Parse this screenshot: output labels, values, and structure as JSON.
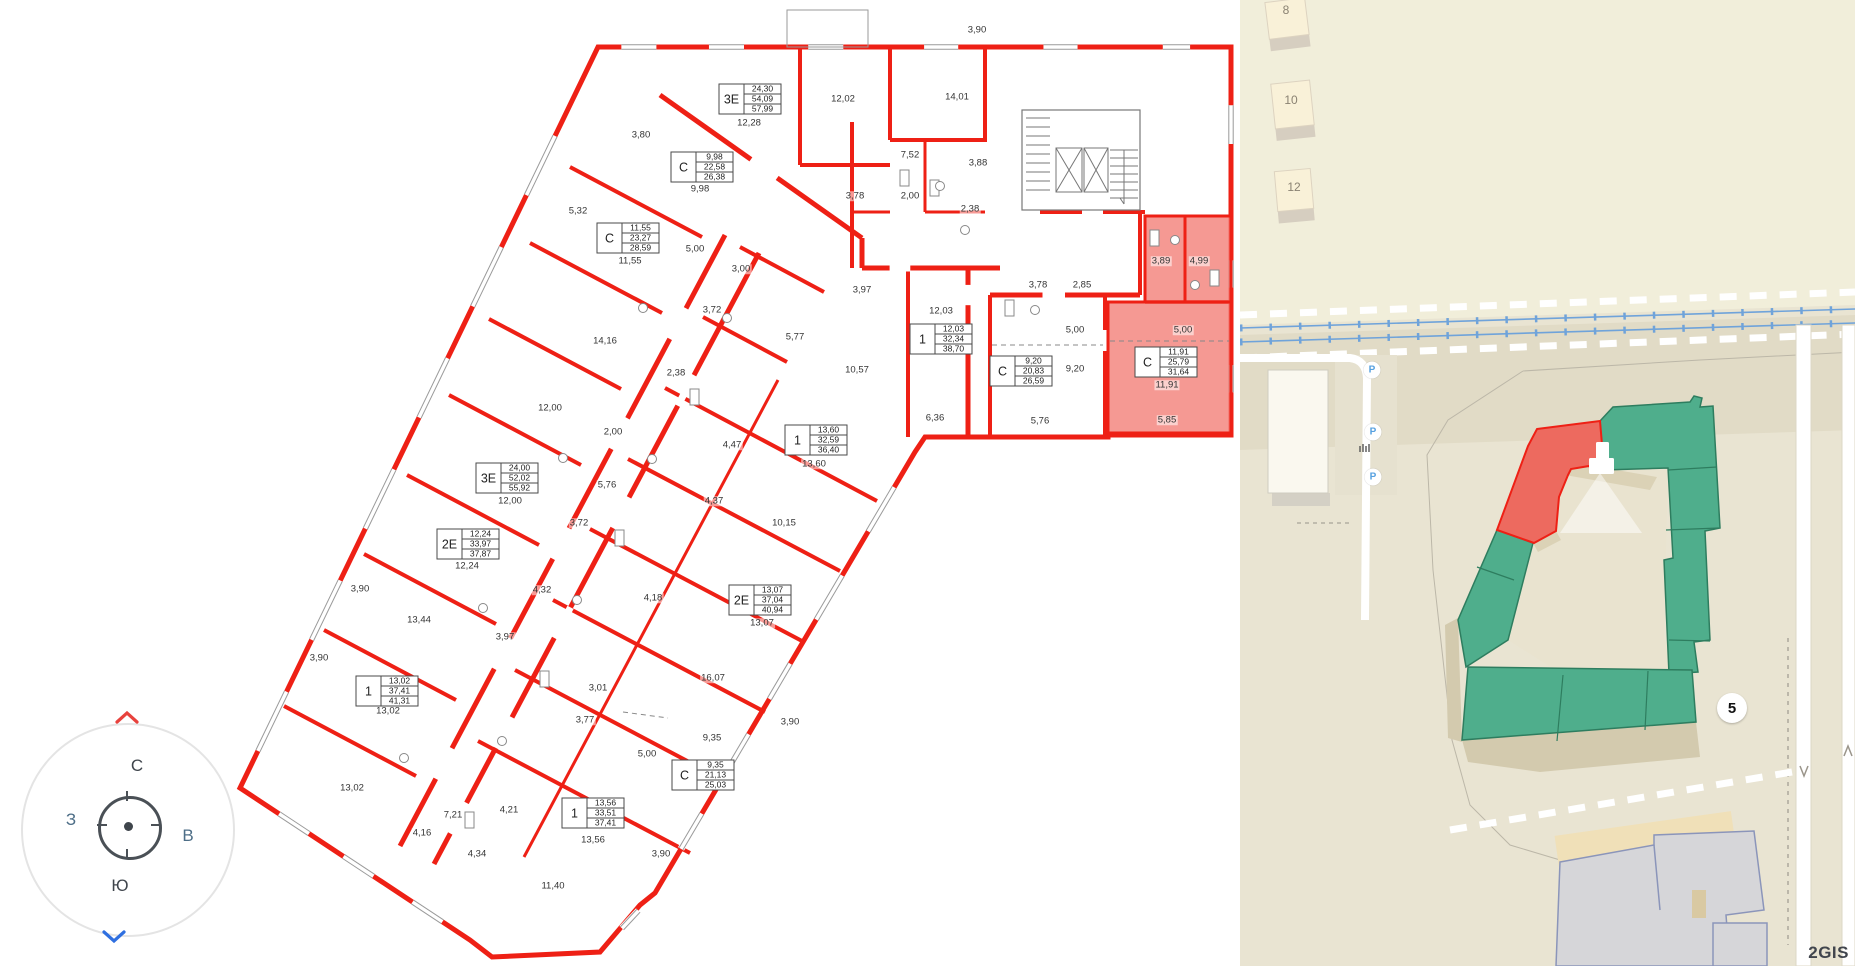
{
  "colors": {
    "wall_red": "#ee2015",
    "highlight_fill": "#f28078",
    "gray_line": "#9a9a9a",
    "map_bg": "#e9e4d2",
    "map_bg_upper": "#f1eeda",
    "map_bg_band": "#e1dbc6",
    "building_cream": "#f9f1d8",
    "building_shadow": "#d6cec0",
    "green_fill": "#4fae8c",
    "green_border": "#2e7d5f",
    "red_fill": "#ed6a5f",
    "gray_building": "#d6d6d9",
    "gray_building_border": "#8b95ba",
    "railway_blue": "#6fa3da",
    "parking_blue": "#57a1e0"
  },
  "floorplan": {
    "apartments": [
      {
        "type": "3Е",
        "values": [
          "24,30",
          "54,09",
          "57,99"
        ],
        "x": 750,
        "y": 99,
        "highlighted": false
      },
      {
        "type": "С",
        "values": [
          "9,98",
          "22,58",
          "26,38"
        ],
        "x": 702,
        "y": 167,
        "highlighted": false
      },
      {
        "type": "С",
        "values": [
          "11,55",
          "23,27",
          "28,59"
        ],
        "x": 628,
        "y": 238,
        "highlighted": false
      },
      {
        "type": "1",
        "values": [
          "12,03",
          "32,34",
          "38,70"
        ],
        "x": 941,
        "y": 339,
        "highlighted": false
      },
      {
        "type": "С",
        "values": [
          "9,20",
          "20,83",
          "26,59"
        ],
        "x": 1021,
        "y": 371,
        "highlighted": false
      },
      {
        "type": "С",
        "values": [
          "11,91",
          "25,79",
          "31,64"
        ],
        "x": 1166,
        "y": 362,
        "highlighted": true
      },
      {
        "type": "1",
        "values": [
          "13,60",
          "32,59",
          "36,40"
        ],
        "x": 816,
        "y": 440,
        "highlighted": false
      },
      {
        "type": "3Е",
        "values": [
          "24,00",
          "52,02",
          "55,92"
        ],
        "x": 507,
        "y": 478,
        "highlighted": false
      },
      {
        "type": "2Е",
        "values": [
          "12,24",
          "33,97",
          "37,87"
        ],
        "x": 468,
        "y": 544,
        "highlighted": false
      },
      {
        "type": "2Е",
        "values": [
          "13,07",
          "37,04",
          "40,94"
        ],
        "x": 760,
        "y": 600,
        "highlighted": false
      },
      {
        "type": "1",
        "values": [
          "13,02",
          "37,41",
          "41,31"
        ],
        "x": 387,
        "y": 691,
        "highlighted": false
      },
      {
        "type": "С",
        "values": [
          "9,35",
          "21,13",
          "25,03"
        ],
        "x": 703,
        "y": 775,
        "highlighted": false
      },
      {
        "type": "1",
        "values": [
          "13,56",
          "33,51",
          "37,41"
        ],
        "x": 593,
        "y": 813,
        "highlighted": false
      }
    ],
    "dimensions": [
      {
        "t": "3,90",
        "x": 977,
        "y": 30
      },
      {
        "t": "12,28",
        "x": 749,
        "y": 123
      },
      {
        "t": "12,02",
        "x": 843,
        "y": 99
      },
      {
        "t": "14,01",
        "x": 957,
        "y": 97
      },
      {
        "t": "3,80",
        "x": 641,
        "y": 135
      },
      {
        "t": "7,52",
        "x": 910,
        "y": 155
      },
      {
        "t": "3,88",
        "x": 978,
        "y": 163
      },
      {
        "t": "9,98",
        "x": 700,
        "y": 189
      },
      {
        "t": "3,78",
        "x": 855,
        "y": 196
      },
      {
        "t": "2,00",
        "x": 910,
        "y": 196
      },
      {
        "t": "2,38",
        "x": 970,
        "y": 209
      },
      {
        "t": "5,32",
        "x": 578,
        "y": 211
      },
      {
        "t": "5,00",
        "x": 695,
        "y": 249
      },
      {
        "t": "11,55",
        "x": 630,
        "y": 261
      },
      {
        "t": "3,00",
        "x": 741,
        "y": 269
      },
      {
        "t": "3,89",
        "x": 1161,
        "y": 261
      },
      {
        "t": "4,99",
        "x": 1199,
        "y": 261
      },
      {
        "t": "3,78",
        "x": 1038,
        "y": 285
      },
      {
        "t": "2,85",
        "x": 1082,
        "y": 285
      },
      {
        "t": "3,97",
        "x": 862,
        "y": 290
      },
      {
        "t": "3,72",
        "x": 712,
        "y": 310
      },
      {
        "t": "12,03",
        "x": 941,
        "y": 311
      },
      {
        "t": "5,00",
        "x": 1075,
        "y": 330
      },
      {
        "t": "5,00",
        "x": 1183,
        "y": 330
      },
      {
        "t": "5,77",
        "x": 795,
        "y": 337
      },
      {
        "t": "14,16",
        "x": 605,
        "y": 341
      },
      {
        "t": "9,20",
        "x": 1075,
        "y": 369
      },
      {
        "t": "10,57",
        "x": 857,
        "y": 370
      },
      {
        "t": "2,38",
        "x": 676,
        "y": 373
      },
      {
        "t": "11,91",
        "x": 1167,
        "y": 385
      },
      {
        "t": "12,00",
        "x": 550,
        "y": 408
      },
      {
        "t": "6,36",
        "x": 935,
        "y": 418
      },
      {
        "t": "5,76",
        "x": 1040,
        "y": 421
      },
      {
        "t": "5,85",
        "x": 1167,
        "y": 420
      },
      {
        "t": "2,00",
        "x": 613,
        "y": 432
      },
      {
        "t": "4,47",
        "x": 732,
        "y": 445
      },
      {
        "t": "13,60",
        "x": 814,
        "y": 464
      },
      {
        "t": "5,76",
        "x": 607,
        "y": 485
      },
      {
        "t": "12,00",
        "x": 510,
        "y": 501
      },
      {
        "t": "4,37",
        "x": 714,
        "y": 501
      },
      {
        "t": "3,72",
        "x": 579,
        "y": 523
      },
      {
        "t": "10,15",
        "x": 784,
        "y": 523
      },
      {
        "t": "12,24",
        "x": 467,
        "y": 566
      },
      {
        "t": "3,90",
        "x": 360,
        "y": 589
      },
      {
        "t": "4,32",
        "x": 542,
        "y": 590
      },
      {
        "t": "4,18",
        "x": 653,
        "y": 598
      },
      {
        "t": "13,44",
        "x": 419,
        "y": 620
      },
      {
        "t": "13,07",
        "x": 762,
        "y": 623
      },
      {
        "t": "3,97",
        "x": 505,
        "y": 637
      },
      {
        "t": "3,90",
        "x": 319,
        "y": 658
      },
      {
        "t": "16,07",
        "x": 713,
        "y": 678
      },
      {
        "t": "3,01",
        "x": 598,
        "y": 688
      },
      {
        "t": "13,02",
        "x": 388,
        "y": 711
      },
      {
        "t": "3,77",
        "x": 585,
        "y": 720
      },
      {
        "t": "3,90",
        "x": 790,
        "y": 722
      },
      {
        "t": "9,35",
        "x": 712,
        "y": 738
      },
      {
        "t": "5,00",
        "x": 647,
        "y": 754
      },
      {
        "t": "3,90",
        "x": 717,
        "y": 785
      },
      {
        "t": "13,02",
        "x": 352,
        "y": 788
      },
      {
        "t": "4,21",
        "x": 509,
        "y": 810
      },
      {
        "t": "7,21",
        "x": 453,
        "y": 815
      },
      {
        "t": "4,16",
        "x": 422,
        "y": 833
      },
      {
        "t": "13,56",
        "x": 593,
        "y": 840
      },
      {
        "t": "4,34",
        "x": 477,
        "y": 854
      },
      {
        "t": "3,90",
        "x": 661,
        "y": 854
      },
      {
        "t": "11,40",
        "x": 553,
        "y": 886
      }
    ]
  },
  "map": {
    "building_numbers": [
      {
        "t": "8",
        "x": 1286,
        "y": 10
      },
      {
        "t": "10",
        "x": 1291,
        "y": 100
      },
      {
        "t": "12",
        "x": 1294,
        "y": 187
      }
    ],
    "badge": {
      "t": "5",
      "x": 1732,
      "y": 708
    },
    "parking_label": "Р",
    "parking": [
      {
        "x": 1372,
        "y": 370
      },
      {
        "x": 1373,
        "y": 432
      },
      {
        "x": 1373,
        "y": 477
      }
    ],
    "watermark": "2GIS"
  },
  "compass": {
    "north": "С",
    "south": "Ю",
    "west": "З",
    "east": "В"
  }
}
